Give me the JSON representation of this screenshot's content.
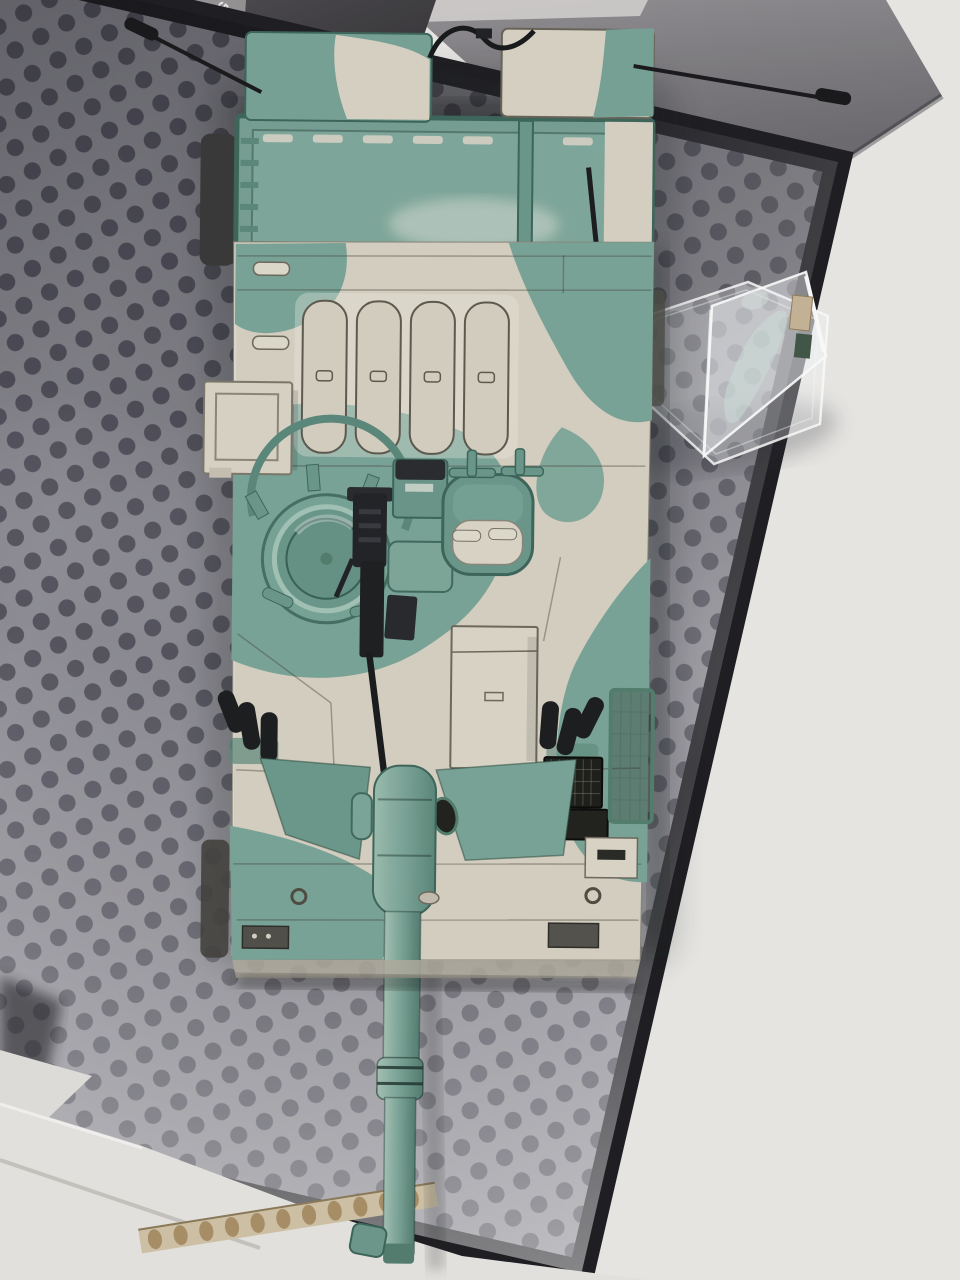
{
  "scene": {
    "alt": "Top-down photo of a green and white camouflaged scale-model tank lying in an open presentation box with a clear display stand",
    "objects": {
      "tank": "scale model tank seen from above, gun barrel pointing down",
      "display_stand": "clear acrylic hexagonal display stand with etched plaque",
      "tray": "dark gray hexagon-dot foam tray",
      "box_lid": "dark gray box lid leaning at top right",
      "box_panel": "gray box side panel with diagonal printed slogan",
      "cardboard": "white cardboard lid with corrugated torn edge at bottom"
    },
    "colors": {
      "camo_green": "#7ca79a",
      "camo_green_dark": "#5d8a7d",
      "camo_sand": "#d8d3c4",
      "tray_gray": "#8f8e96",
      "tray_dot": "#565560",
      "panel_gray": "#949194",
      "background_white": "#ecebe8",
      "metal_black": "#232427",
      "cardboard_tan": "#ab9169"
    }
  },
  "box_text": {
    "lines": [
      "ALL & STYLIS",
      "R SMARTPHONE",
      "WAS BORN AFTER OU",
      "O THIS DIFFICULT SUBJEC",
      "DESK INTO AN EXCITING BAT",
      "SY-TO-ASSEMBLE AND FULLY DETA"
    ]
  }
}
